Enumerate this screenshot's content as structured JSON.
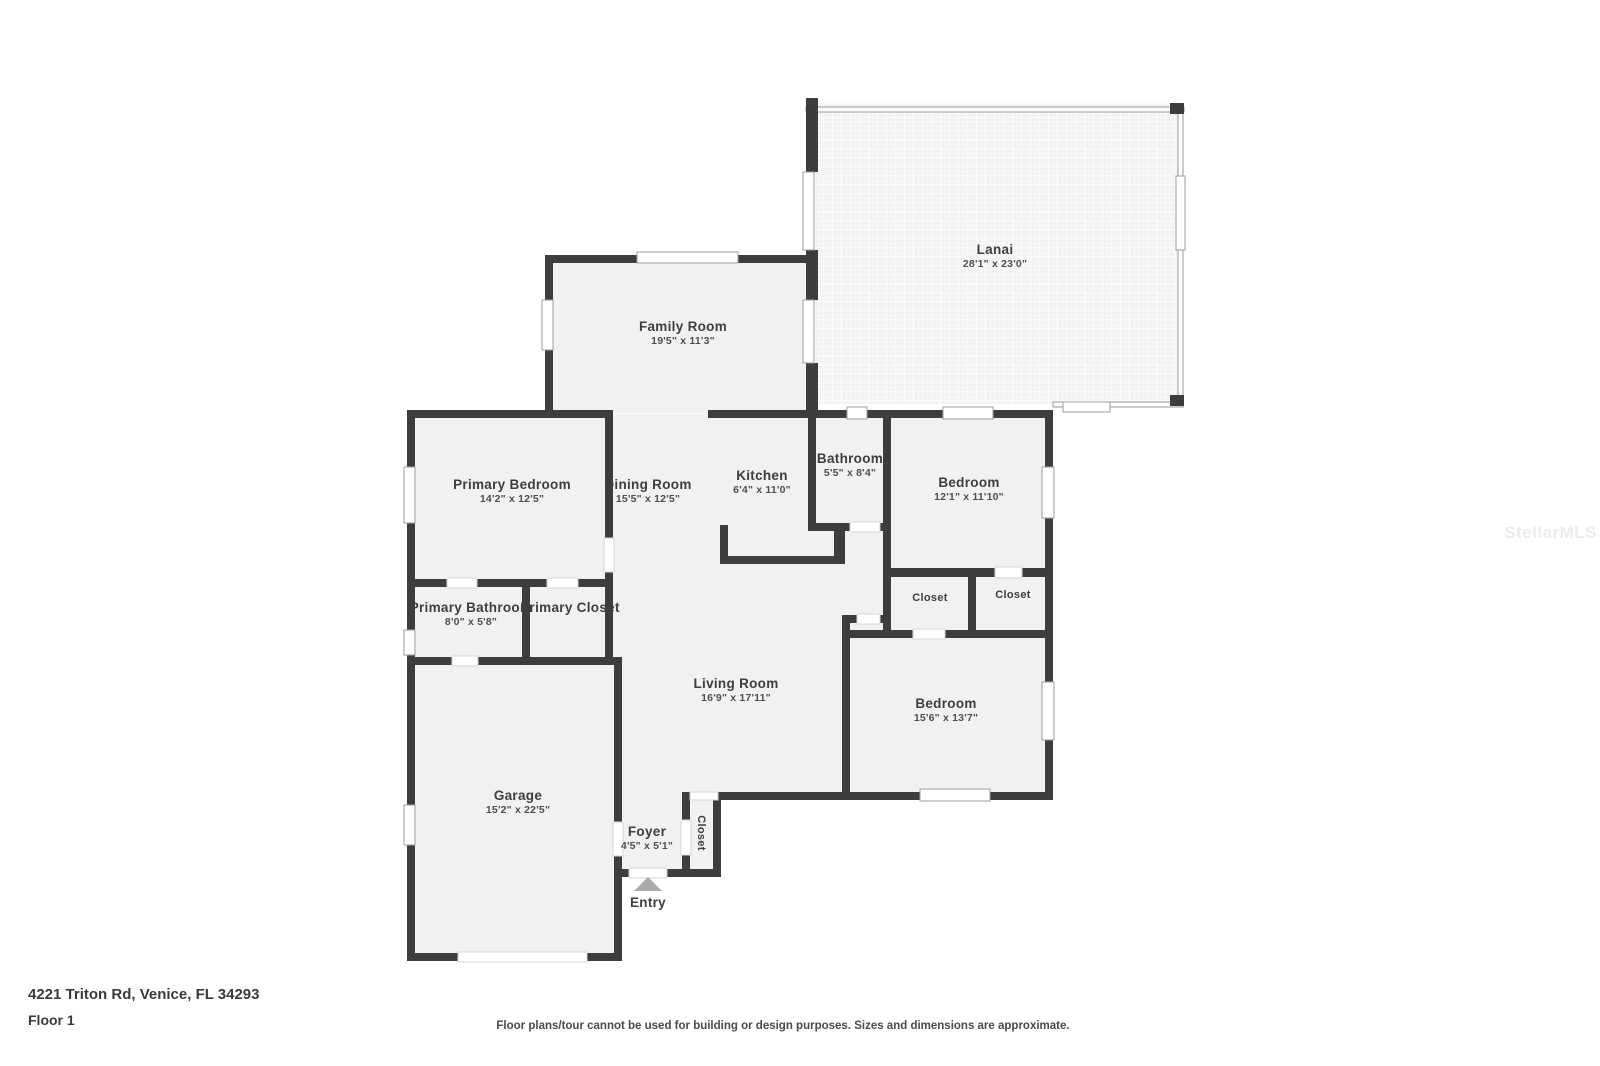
{
  "footer": {
    "address": "4221 Triton Rd, Venice, FL 34293",
    "floor": "Floor 1",
    "disclaimer": "Floor plans/tour cannot be used for building or design purposes. Sizes and dimensions are approximate."
  },
  "watermark": "StellarMLS",
  "colors": {
    "wall": "#3d3d3d",
    "room_fill": "#f1f1f1",
    "lanai_fill": "#f7f7f7",
    "screen_wall": "#9a9a9a",
    "label_text": "#3e3e3e",
    "entry_arrow": "#aaaaaa"
  },
  "entry": {
    "label": "Entry",
    "arrow_icon": "triangle-up"
  },
  "rooms": [
    {
      "id": "lanai",
      "label": "Lanai",
      "dims": "28'1\" x 23'0\""
    },
    {
      "id": "family-room",
      "label": "Family Room",
      "dims": "19'5\" x 11'3\""
    },
    {
      "id": "primary-bedroom",
      "label": "Primary Bedroom",
      "dims": "14'2\" x 12'5\""
    },
    {
      "id": "dining-room",
      "label": "Dining Room",
      "dims": "15'5\" x 12'5\""
    },
    {
      "id": "kitchen",
      "label": "Kitchen",
      "dims": "6'4\" x 11'0\""
    },
    {
      "id": "bathroom",
      "label": "Bathroom",
      "dims": "5'5\" x 8'4\""
    },
    {
      "id": "bedroom-1",
      "label": "Bedroom",
      "dims": "12'1\" x 11'10\""
    },
    {
      "id": "primary-bathroom",
      "label": "Primary Bathroom",
      "dims": "8'0\" x 5'8\""
    },
    {
      "id": "primary-closet",
      "label": "Primary Closet"
    },
    {
      "id": "closet-hall-left",
      "label": "Closet"
    },
    {
      "id": "closet-hall-right",
      "label": "Closet"
    },
    {
      "id": "living-room",
      "label": "Living Room",
      "dims": "16'9\" x 17'11\""
    },
    {
      "id": "bedroom-2",
      "label": "Bedroom",
      "dims": "15'6\" x 13'7\""
    },
    {
      "id": "garage",
      "label": "Garage",
      "dims": "15'2\" x 22'5\""
    },
    {
      "id": "foyer",
      "label": "Foyer",
      "dims": "4'5\" x 5'1\""
    },
    {
      "id": "closet-foyer",
      "label": "Closet"
    }
  ]
}
